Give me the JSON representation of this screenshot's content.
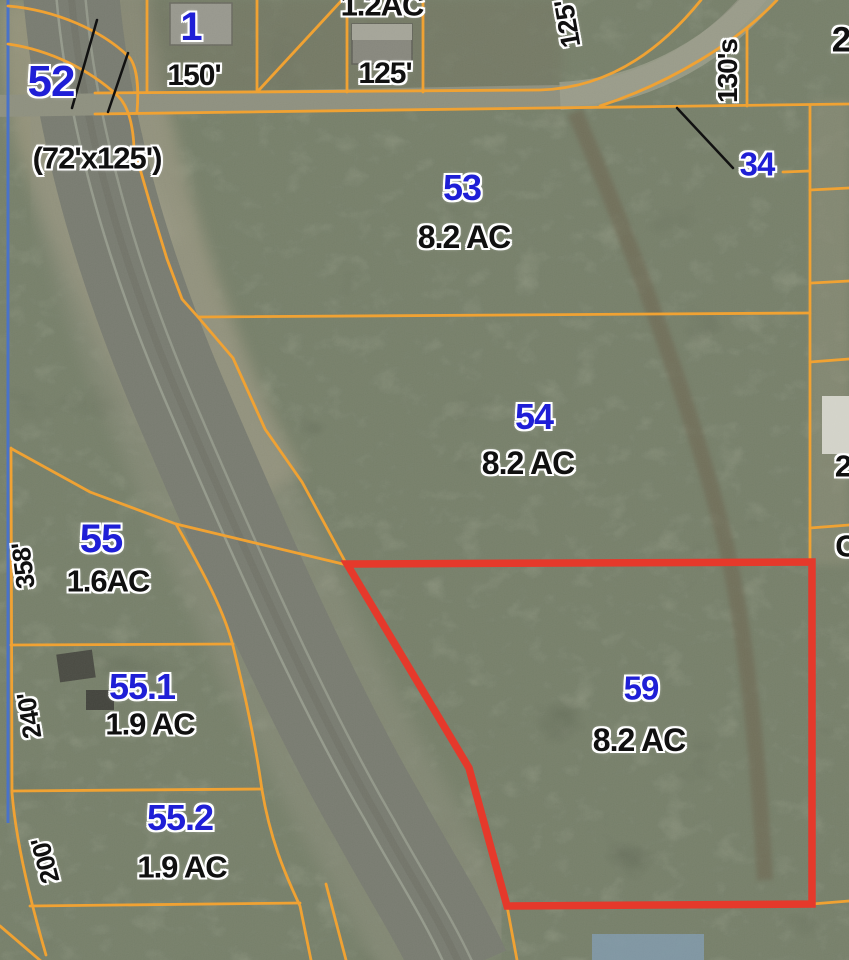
{
  "title": "Aerial parcel map with highlighted lot 59",
  "highlighted_parcel": {
    "number": "59",
    "acreage": "8.2 AC"
  },
  "colors": {
    "boundary_orange": "#F0A233",
    "highlight_red": "#E5392B",
    "parcel_number_blue": "#1F1FD6",
    "dimension_black": "#111111",
    "survey_blue_line": "#4A73C8"
  },
  "labels": [
    {
      "name": "parcel-52",
      "text": "52"
    },
    {
      "name": "note-72x125",
      "text": "(72'x125')"
    },
    {
      "name": "parcel-1",
      "text": "1"
    },
    {
      "name": "dim-150",
      "text": "150'"
    },
    {
      "name": "acreage-1-2",
      "text": "1.2AC"
    },
    {
      "name": "dim-125",
      "text": "125'"
    },
    {
      "name": "dim-125-rot",
      "text": "125'"
    },
    {
      "name": "dim-130s",
      "text": "130's"
    },
    {
      "name": "parcel-34",
      "text": "34"
    },
    {
      "name": "edge-2-top",
      "text": "2"
    },
    {
      "name": "parcel-53",
      "text": "53"
    },
    {
      "name": "acreage-53",
      "text": "8.2 AC"
    },
    {
      "name": "parcel-54",
      "text": "54"
    },
    {
      "name": "acreage-54",
      "text": "8.2 AC"
    },
    {
      "name": "parcel-55",
      "text": "55"
    },
    {
      "name": "acreage-55",
      "text": "1.6AC"
    },
    {
      "name": "dim-358",
      "text": "358'"
    },
    {
      "name": "parcel-55-1",
      "text": "55.1"
    },
    {
      "name": "acreage-55-1",
      "text": "1.9 AC"
    },
    {
      "name": "dim-240",
      "text": "240'"
    },
    {
      "name": "parcel-55-2",
      "text": "55.2"
    },
    {
      "name": "acreage-55-2",
      "text": "1.9 AC"
    },
    {
      "name": "dim-200",
      "text": "200'"
    },
    {
      "name": "parcel-59",
      "text": "59"
    },
    {
      "name": "acreage-59",
      "text": "8.2 AC"
    },
    {
      "name": "edge-2-right",
      "text": "2"
    },
    {
      "name": "edge-c-right",
      "text": "C"
    }
  ]
}
